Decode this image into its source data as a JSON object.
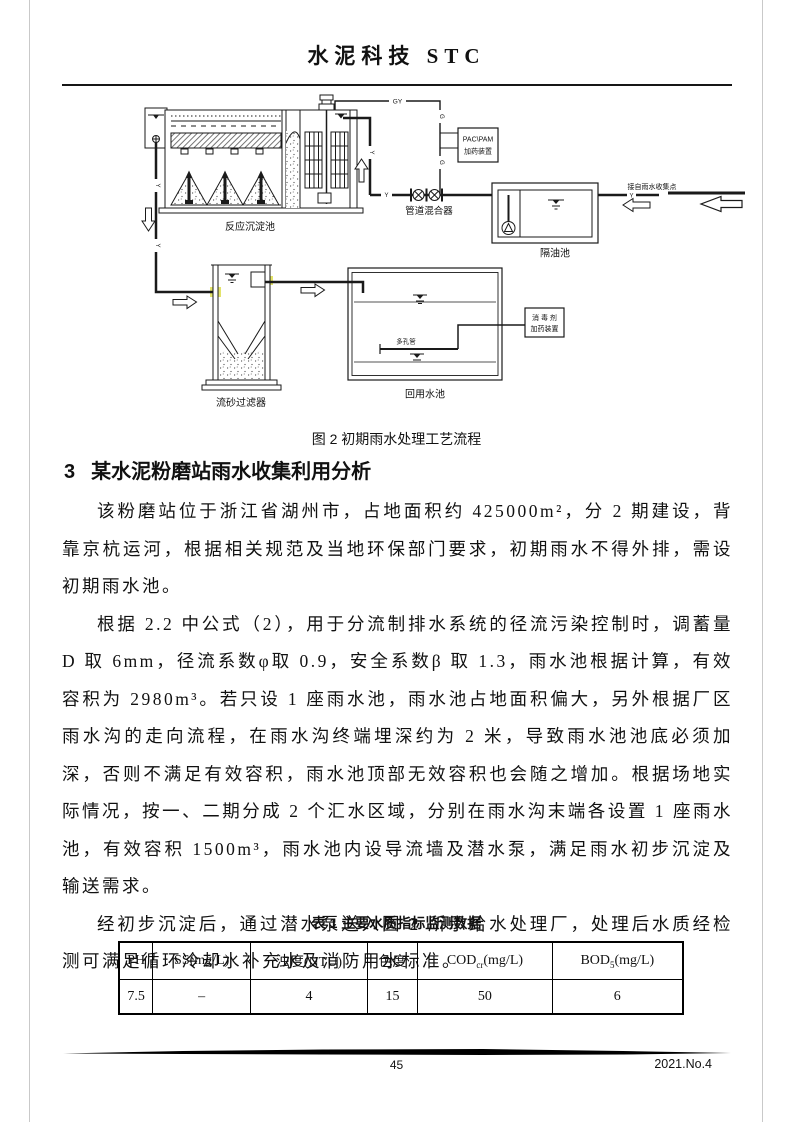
{
  "page": {
    "header_title": "水泥科技 STC",
    "footer": {
      "page_number": "45",
      "issue": "2021.No.4"
    }
  },
  "figure": {
    "caption": "图 2 初期雨水处理工艺流程",
    "labels": {
      "reaction_tank": "反应沉淀池",
      "pipe_mixer": "管道混合器",
      "pac_line1": "PAC\\PAM",
      "pac_line2": "加药装置",
      "oil_tank": "隔油池",
      "inlet_note": "接自雨水收集点",
      "sand_filter": "流砂过滤器",
      "reuse_tank": "回用水池",
      "porous_pipe": "多孔管",
      "disinfectant_line1": "消 毒 剂",
      "disinfectant_line2": "加药装置",
      "gy": "GY",
      "g": "G",
      "y": "Y"
    }
  },
  "section": {
    "number": "3",
    "title": "某水泥粉磨站雨水收集利用分析"
  },
  "body": {
    "paragraphs": [
      "该粉磨站位于浙江省湖州市，占地面积约 425000m²，分 2 期建设，背靠京杭运河，根据相关规范及当地环保部门要求，初期雨水不得外排，需设初期雨水池。",
      "根据 2.2 中公式（2），用于分流制排水系统的径流污染控制时，调蓄量 D 取 6mm，径流系数φ取 0.9，安全系数β 取 1.3，雨水池根据计算，有效容积为 2980m³。若只设 1 座雨水池，雨水池占地面积偏大，另外根据厂区雨水沟的走向流程，在雨水沟终端埋深约为 2 米，导致雨水池池底必须加深，否则不满足有效容积，雨水池顶部无效容积也会随之增加。根据场地实际情况，按一、二期分成 2 个汇水区域，分别在雨水沟末端各设置 1 座雨水池，有效容积 1500m³，雨水池内设导流墙及潜水泵，满足雨水初步沉淀及输送需求。",
      "经初步沉淀后，通过潜水泵送入图 2 所示给水处理厂，处理后水质经检测可满足循环冷却水补充水及消防用水标准。"
    ]
  },
  "table": {
    "caption": "表 1 主要水质指标监测数据",
    "headers": [
      {
        "main": "PH",
        "sub": "",
        "post": ""
      },
      {
        "main": "SS",
        "sub": "",
        "post": "(mg/L)"
      },
      {
        "main": "浊度",
        "sub": "",
        "post": "(NTU)"
      },
      {
        "main": "色度",
        "sub": "",
        "post": ""
      },
      {
        "main": "COD",
        "sub": "cr",
        "post": "(mg/L)"
      },
      {
        "main": "BOD",
        "sub": "5",
        "post": "(mg/L)"
      }
    ],
    "values": [
      "7.5",
      "–",
      "4",
      "15",
      "50",
      "6"
    ]
  },
  "colors": {
    "highlight": "#e3e36b",
    "line": "#1a1a1a"
  }
}
